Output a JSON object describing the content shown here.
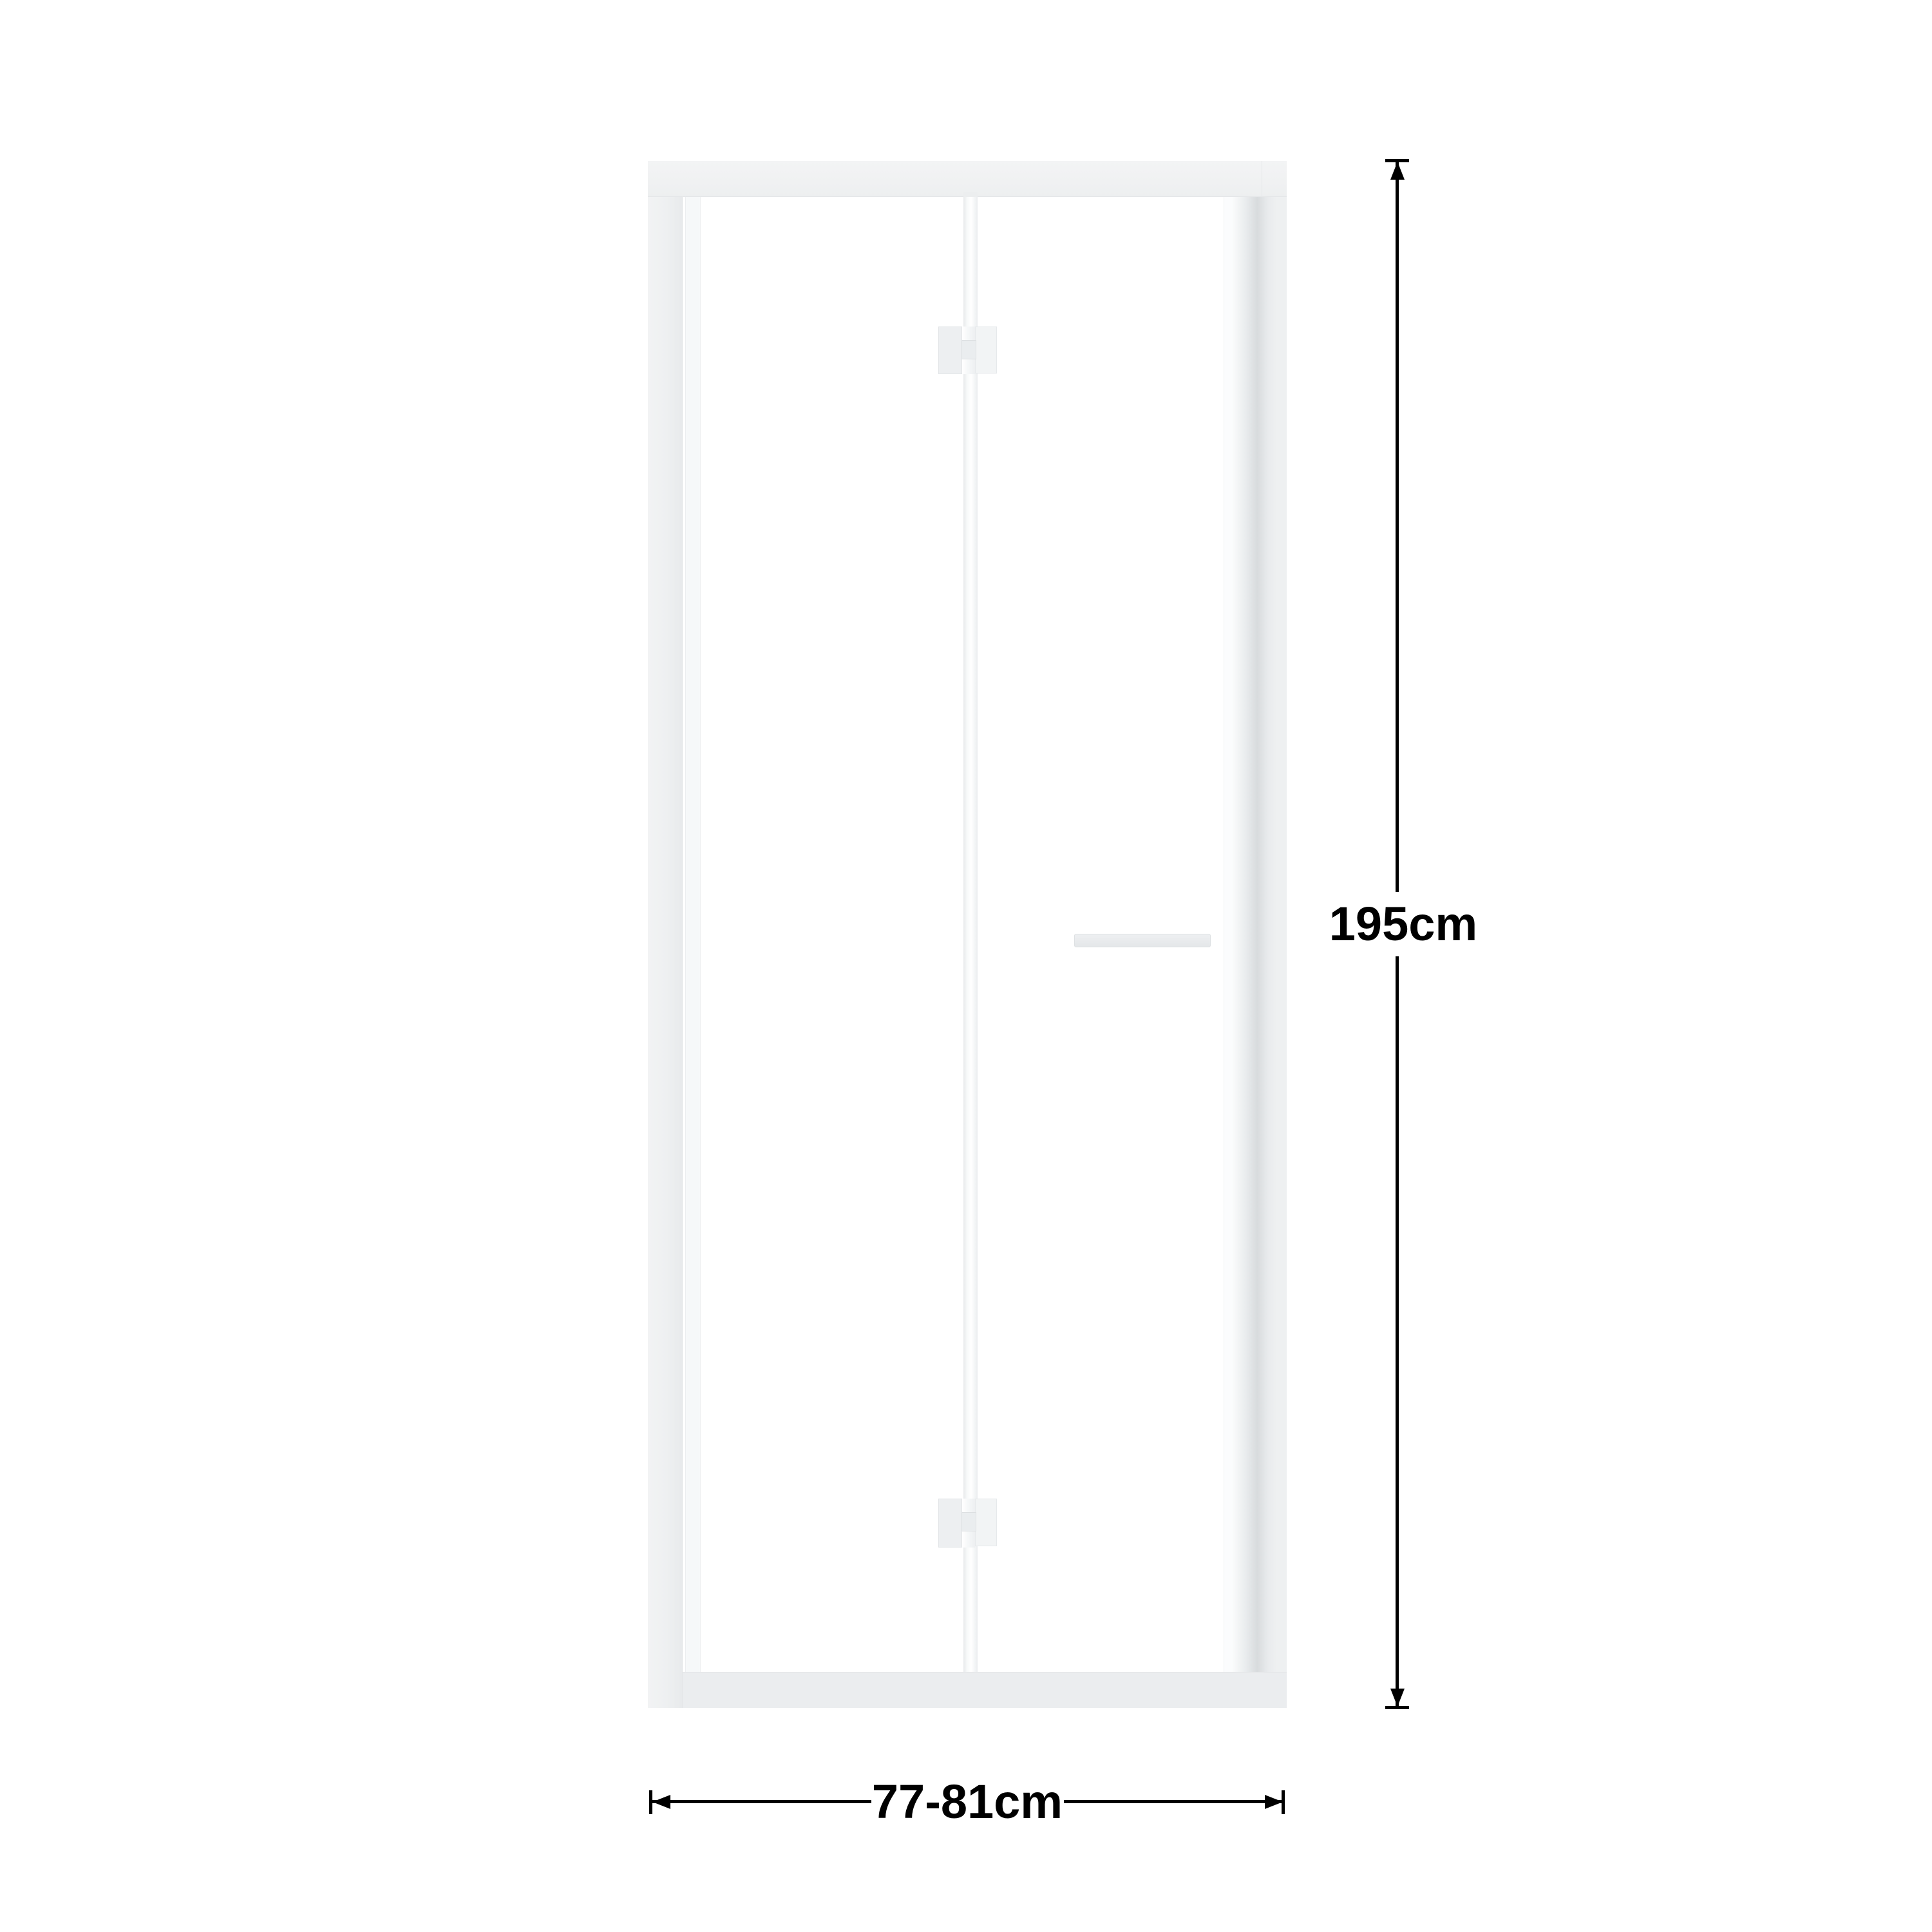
{
  "diagram": {
    "subject": "bifold-shower-door-dimension-diagram",
    "dimensions": {
      "height": {
        "label": "195cm"
      },
      "width": {
        "label": "77-81cm"
      }
    },
    "colors": {
      "background": "#ffffff",
      "frame_face": "#f0f1f2",
      "frame_shade": "#d8dbdd",
      "frame_edge": "#e2e4e6",
      "glass": "#ffffff",
      "glass_tint": "#f6f8f9",
      "hardware_fill": "#eff1f3",
      "hardware_edge": "#dde0e2",
      "dimension_color": "#000000"
    }
  }
}
